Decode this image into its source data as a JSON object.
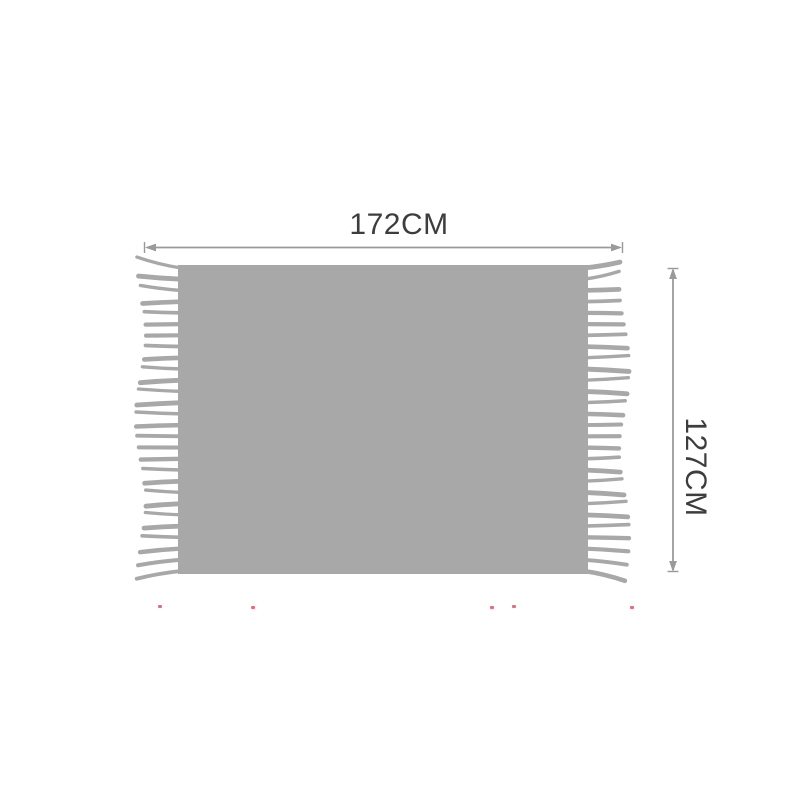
{
  "product_diagram": {
    "width_label": "172CM",
    "height_label": "127CM"
  },
  "colors": {
    "blanket": "#a8a8a8",
    "arrow": "#9a9a9a",
    "label": "#3d3d3d",
    "speck": "#ef5669"
  }
}
